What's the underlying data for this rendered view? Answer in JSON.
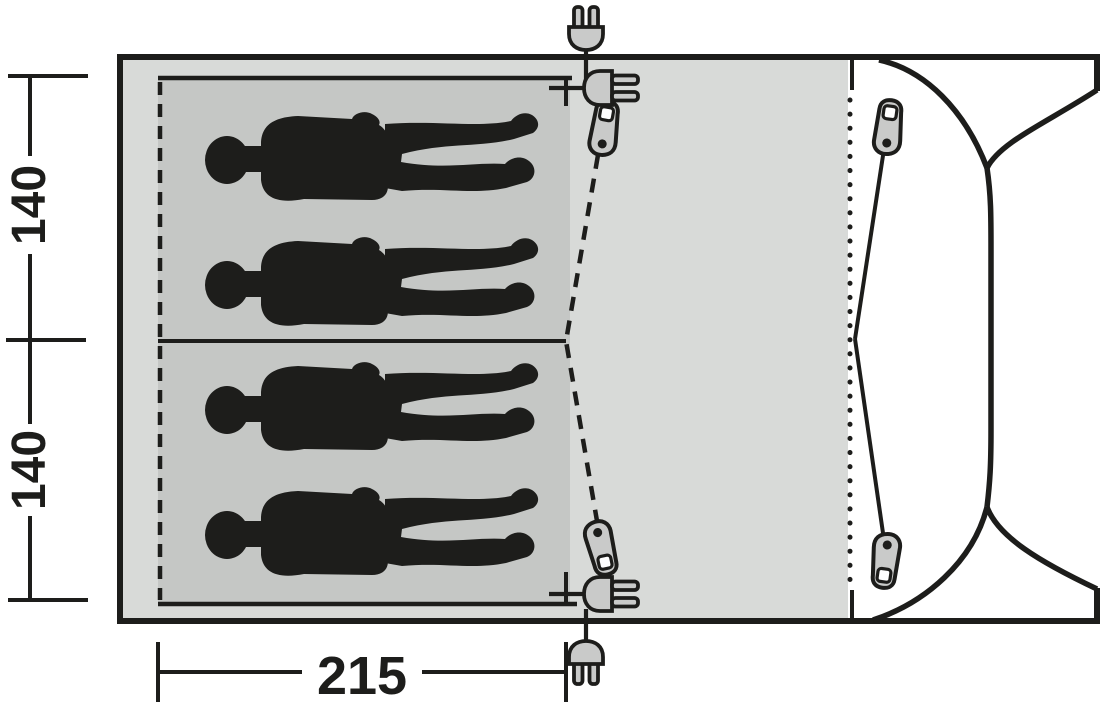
{
  "diagram": {
    "kind": "tent-floor-plan-top-view",
    "dimension_labels": {
      "cabin_top": "140",
      "cabin_bottom": "140",
      "cabin_width": "215"
    },
    "sleeping_cabins": 2,
    "person_count": 4,
    "icons": {
      "top_outside": "power-plug-icon",
      "top_inside": "cable-entry-plug-icon",
      "top_pull": "zipper-pull-icon",
      "bottom_outside": "power-plug-icon",
      "bottom_inside": "cable-entry-plug-icon",
      "bottom_pull": "zipper-pull-icon",
      "door_pulls_right": "zipper-pull-icon"
    },
    "colors": {
      "background": "#ffffff",
      "floor_light_gray": "#d8dad8",
      "sleeping_area_gray": "#c5c7c5",
      "line_black": "#1d1d1b",
      "hardware_gray": "#c9cac9"
    }
  }
}
